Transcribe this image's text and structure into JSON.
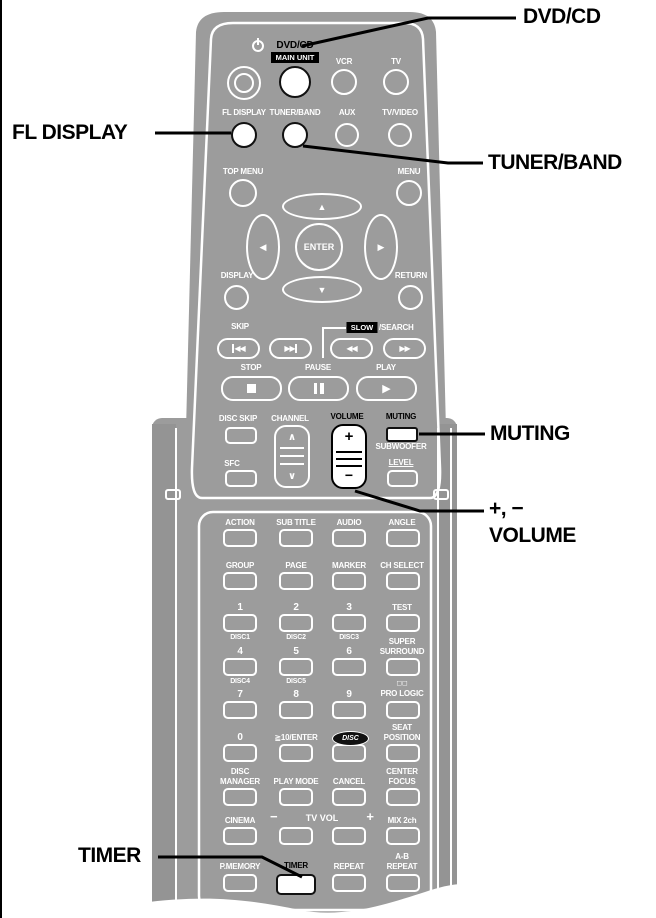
{
  "callouts": {
    "dvd_cd": "DVD/CD",
    "fl_display": "FL DISPLAY",
    "tuner_band": "TUNER/BAND",
    "muting": "MUTING",
    "volume_keys": "+, −",
    "volume": "VOLUME",
    "timer": "TIMER"
  },
  "colors": {
    "body": "#9c9c9c",
    "label": "#ffffff",
    "highlight": "#000000",
    "page": "#ffffff"
  },
  "remote": {
    "top": {
      "dvd_cd": "DVD/CD",
      "main_unit": "MAIN UNIT",
      "vcr": "VCR",
      "tv": "TV",
      "fl_display": "FL DISPLAY",
      "tuner_band": "TUNER/BAND",
      "aux": "AUX",
      "tv_video": "TV/VIDEO"
    },
    "nav": {
      "top_menu": "TOP MENU",
      "menu": "MENU",
      "enter": "ENTER",
      "display": "DISPLAY",
      "return": "RETURN",
      "up": "▲",
      "down": "▼",
      "left": "◀",
      "right": "▶"
    },
    "transport": {
      "skip": "SKIP",
      "slow": "SLOW",
      "search": "/SEARCH",
      "prev": "◀◀",
      "next": "▶▶",
      "rew": "◀◀",
      "ff": "▶▶",
      "stop": "STOP",
      "pause": "PAUSE",
      "play": "PLAY",
      "play_icon": "▶"
    },
    "mid": {
      "disc_skip": "DISC SKIP",
      "channel": "CHANNEL",
      "ch_up": "∧",
      "ch_down": "∨",
      "volume": "VOLUME",
      "vol_plus": "+",
      "vol_minus": "−",
      "muting": "MUTING",
      "subwoofer_line1": "SUBWOOFER",
      "subwoofer_line2": "LEVEL",
      "sfc": "SFC"
    },
    "keypad": {
      "r1": {
        "c1": "ACTION",
        "c2": "SUB TITLE",
        "c3": "AUDIO",
        "c4": "ANGLE"
      },
      "r2": {
        "c1": "GROUP",
        "c2": "PAGE",
        "c3": "MARKER",
        "c4": "CH SELECT"
      },
      "r3": {
        "c1": "1",
        "c1_sub": "DISC1",
        "c2": "2",
        "c2_sub": "DISC2",
        "c3": "3",
        "c3_sub": "DISC3",
        "c4": "TEST"
      },
      "r4": {
        "c1": "4",
        "c1_sub": "DISC4",
        "c2": "5",
        "c2_sub": "DISC5",
        "c3": "6",
        "c4_line1": "SUPER",
        "c4_line2": "SURROUND"
      },
      "r5": {
        "c1": "7",
        "c2": "8",
        "c3": "9",
        "c4_symbol": "◻◻",
        "c4": "PRO LOGIC"
      },
      "r6": {
        "c1": "0",
        "c2": "≧10/ENTER",
        "c3_badge": "DISC",
        "c4_line1": "SEAT",
        "c4_line2": "POSITION"
      },
      "r7": {
        "c1_line1": "DISC",
        "c1_line2": "MANAGER",
        "c2": "PLAY MODE",
        "c3": "CANCEL",
        "c4_line1": "CENTER",
        "c4_line2": "FOCUS"
      },
      "r8": {
        "c1": "CINEMA",
        "tv_vol_minus": "−",
        "tv_vol": "TV VOL",
        "tv_vol_plus": "+",
        "c4": "MIX 2ch"
      },
      "r9": {
        "c1": "P.MEMORY",
        "c2": "TIMER",
        "c3": "REPEAT",
        "c4_line1": "A-B",
        "c4_line2": "REPEAT"
      }
    }
  }
}
